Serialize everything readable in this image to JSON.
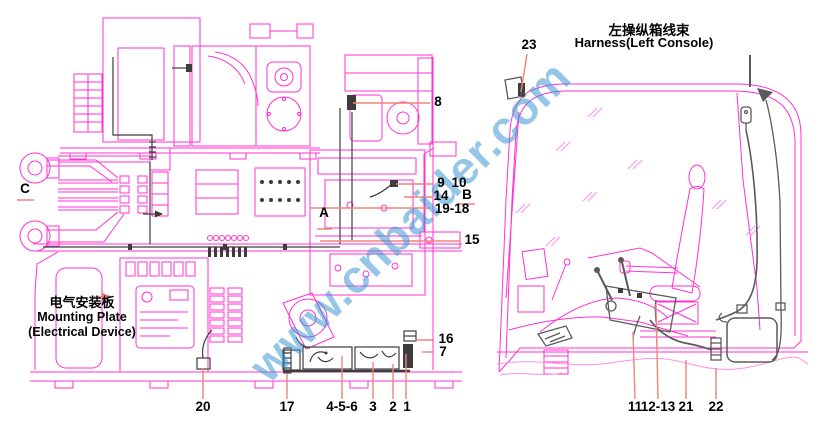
{
  "watermark": {
    "text": "www.cnbaider.com",
    "color": "#3e98d5"
  },
  "left_diagram": {
    "caption_cn": "电气安装板",
    "caption_en_line1": "Mounting Plate",
    "caption_en_line2": "(Electrical Device)",
    "section_labels": {
      "A": "A",
      "B": "B",
      "C": "C"
    },
    "callouts": {
      "n1": "1",
      "n2": "2",
      "n3": "3",
      "n456": "4-5-6",
      "n7": "7",
      "n8": "8",
      "n9": "9",
      "n10": "10",
      "n14": "14",
      "n15": "15",
      "n16": "16",
      "n17": "17",
      "n19_18": "19-18",
      "n20": "20"
    }
  },
  "right_diagram": {
    "title_cn": "左操纵箱线束",
    "title_en": "Harness(Left Console)",
    "callouts": {
      "n11": "11",
      "n12_13": "12-13",
      "n21": "21",
      "n22": "22",
      "n23": "23"
    }
  },
  "colors": {
    "drawing_line": "#ff31d3",
    "drawing_line_light": "#ff8fe6",
    "leader_line": "#f0837a",
    "harness_wire": "#3c3c3c",
    "cab_wire": "#5a5a5a",
    "label_text": "#000000",
    "background": "#ffffff"
  }
}
